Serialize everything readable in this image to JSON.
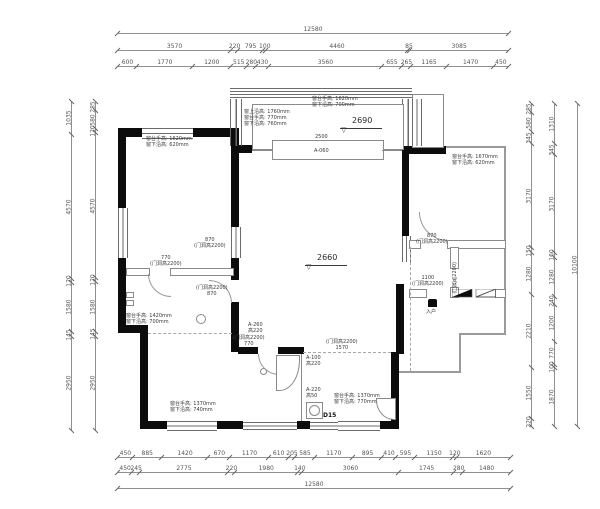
{
  "plan": {
    "levels": [
      {
        "value": "2690"
      },
      {
        "value": "2660"
      }
    ],
    "entry_label": "入户",
    "d15_label": "D15",
    "balcony_dim": "2500",
    "balcony_note": "A-060",
    "annotations": [
      {
        "text": "窗台手高: 1620mm\n窗下沿高: 620mm"
      },
      {
        "text": "窗上沿高: 1760mm\n窗台手高: 770mm\n窗下沿高: 760mm"
      },
      {
        "text": "窗台手高: 1620mm\n窗下沿高: 700mm"
      },
      {
        "text": "窗台手高: 1670mm\n窗下沿高: 620mm"
      },
      {
        "text": "窗台手高: 1420mm\n窗下沿高: 700mm"
      },
      {
        "text": "窗台手高: 1370mm\n窗下沿高: 740mm"
      },
      {
        "text": "窗台手高: 1370mm\n窗下沿高: 770mm"
      },
      {
        "text": "770\n(门洞高2200)"
      },
      {
        "text": "870\n(门洞高2200)"
      },
      {
        "text": "(门洞高2200)\n870"
      },
      {
        "text": "870\n(门洞高2200)"
      },
      {
        "text": "1100\n(门洞高2200)"
      },
      {
        "text": "(门洞高2200)\n770"
      },
      {
        "text": "(门洞高2200)\n1570"
      },
      {
        "text": "A-260\n高220"
      },
      {
        "text": "A-100\n高220"
      },
      {
        "text": "A-220\n高50"
      },
      {
        "text": "(门洞高2200)"
      }
    ],
    "colors": {
      "wall": "#0c0c0c",
      "thin_line": "#8a8a8a",
      "dimension": "#555555"
    }
  },
  "dimensions": {
    "top": [
      [
        "12580"
      ],
      [
        "3570",
        "220",
        "795",
        "100",
        "4460",
        "85",
        "3085"
      ],
      [
        "600",
        "1770",
        "1200",
        "515",
        "280",
        "430",
        "3560",
        "655",
        "265",
        "1165",
        "1470",
        "450"
      ]
    ],
    "bottom": [
      [
        "450",
        "885",
        "1420",
        "670",
        "1170",
        "610",
        "205",
        "585",
        "1170",
        "895",
        "410",
        "595",
        "1150",
        "120",
        "1620"
      ],
      [
        "450",
        "245",
        "2775",
        "220",
        "1980",
        "140",
        "3060",
        "1745",
        "280",
        "1480"
      ],
      [
        "12580"
      ]
    ],
    "left": [
      [
        "1035",
        "4570",
        "120",
        "1580",
        "145",
        "2950"
      ],
      [
        "285",
        "580",
        "120",
        "4570",
        "120",
        "1580",
        "145",
        "2950"
      ]
    ],
    "right": [
      [
        "285",
        "580",
        "345",
        "3170",
        "150",
        "1280",
        "2210",
        "1550",
        "220"
      ],
      [
        "1310",
        "345",
        "3170",
        "160",
        "1280",
        "240",
        "1200",
        "770",
        "100",
        "1870"
      ],
      [
        "10100"
      ]
    ]
  }
}
